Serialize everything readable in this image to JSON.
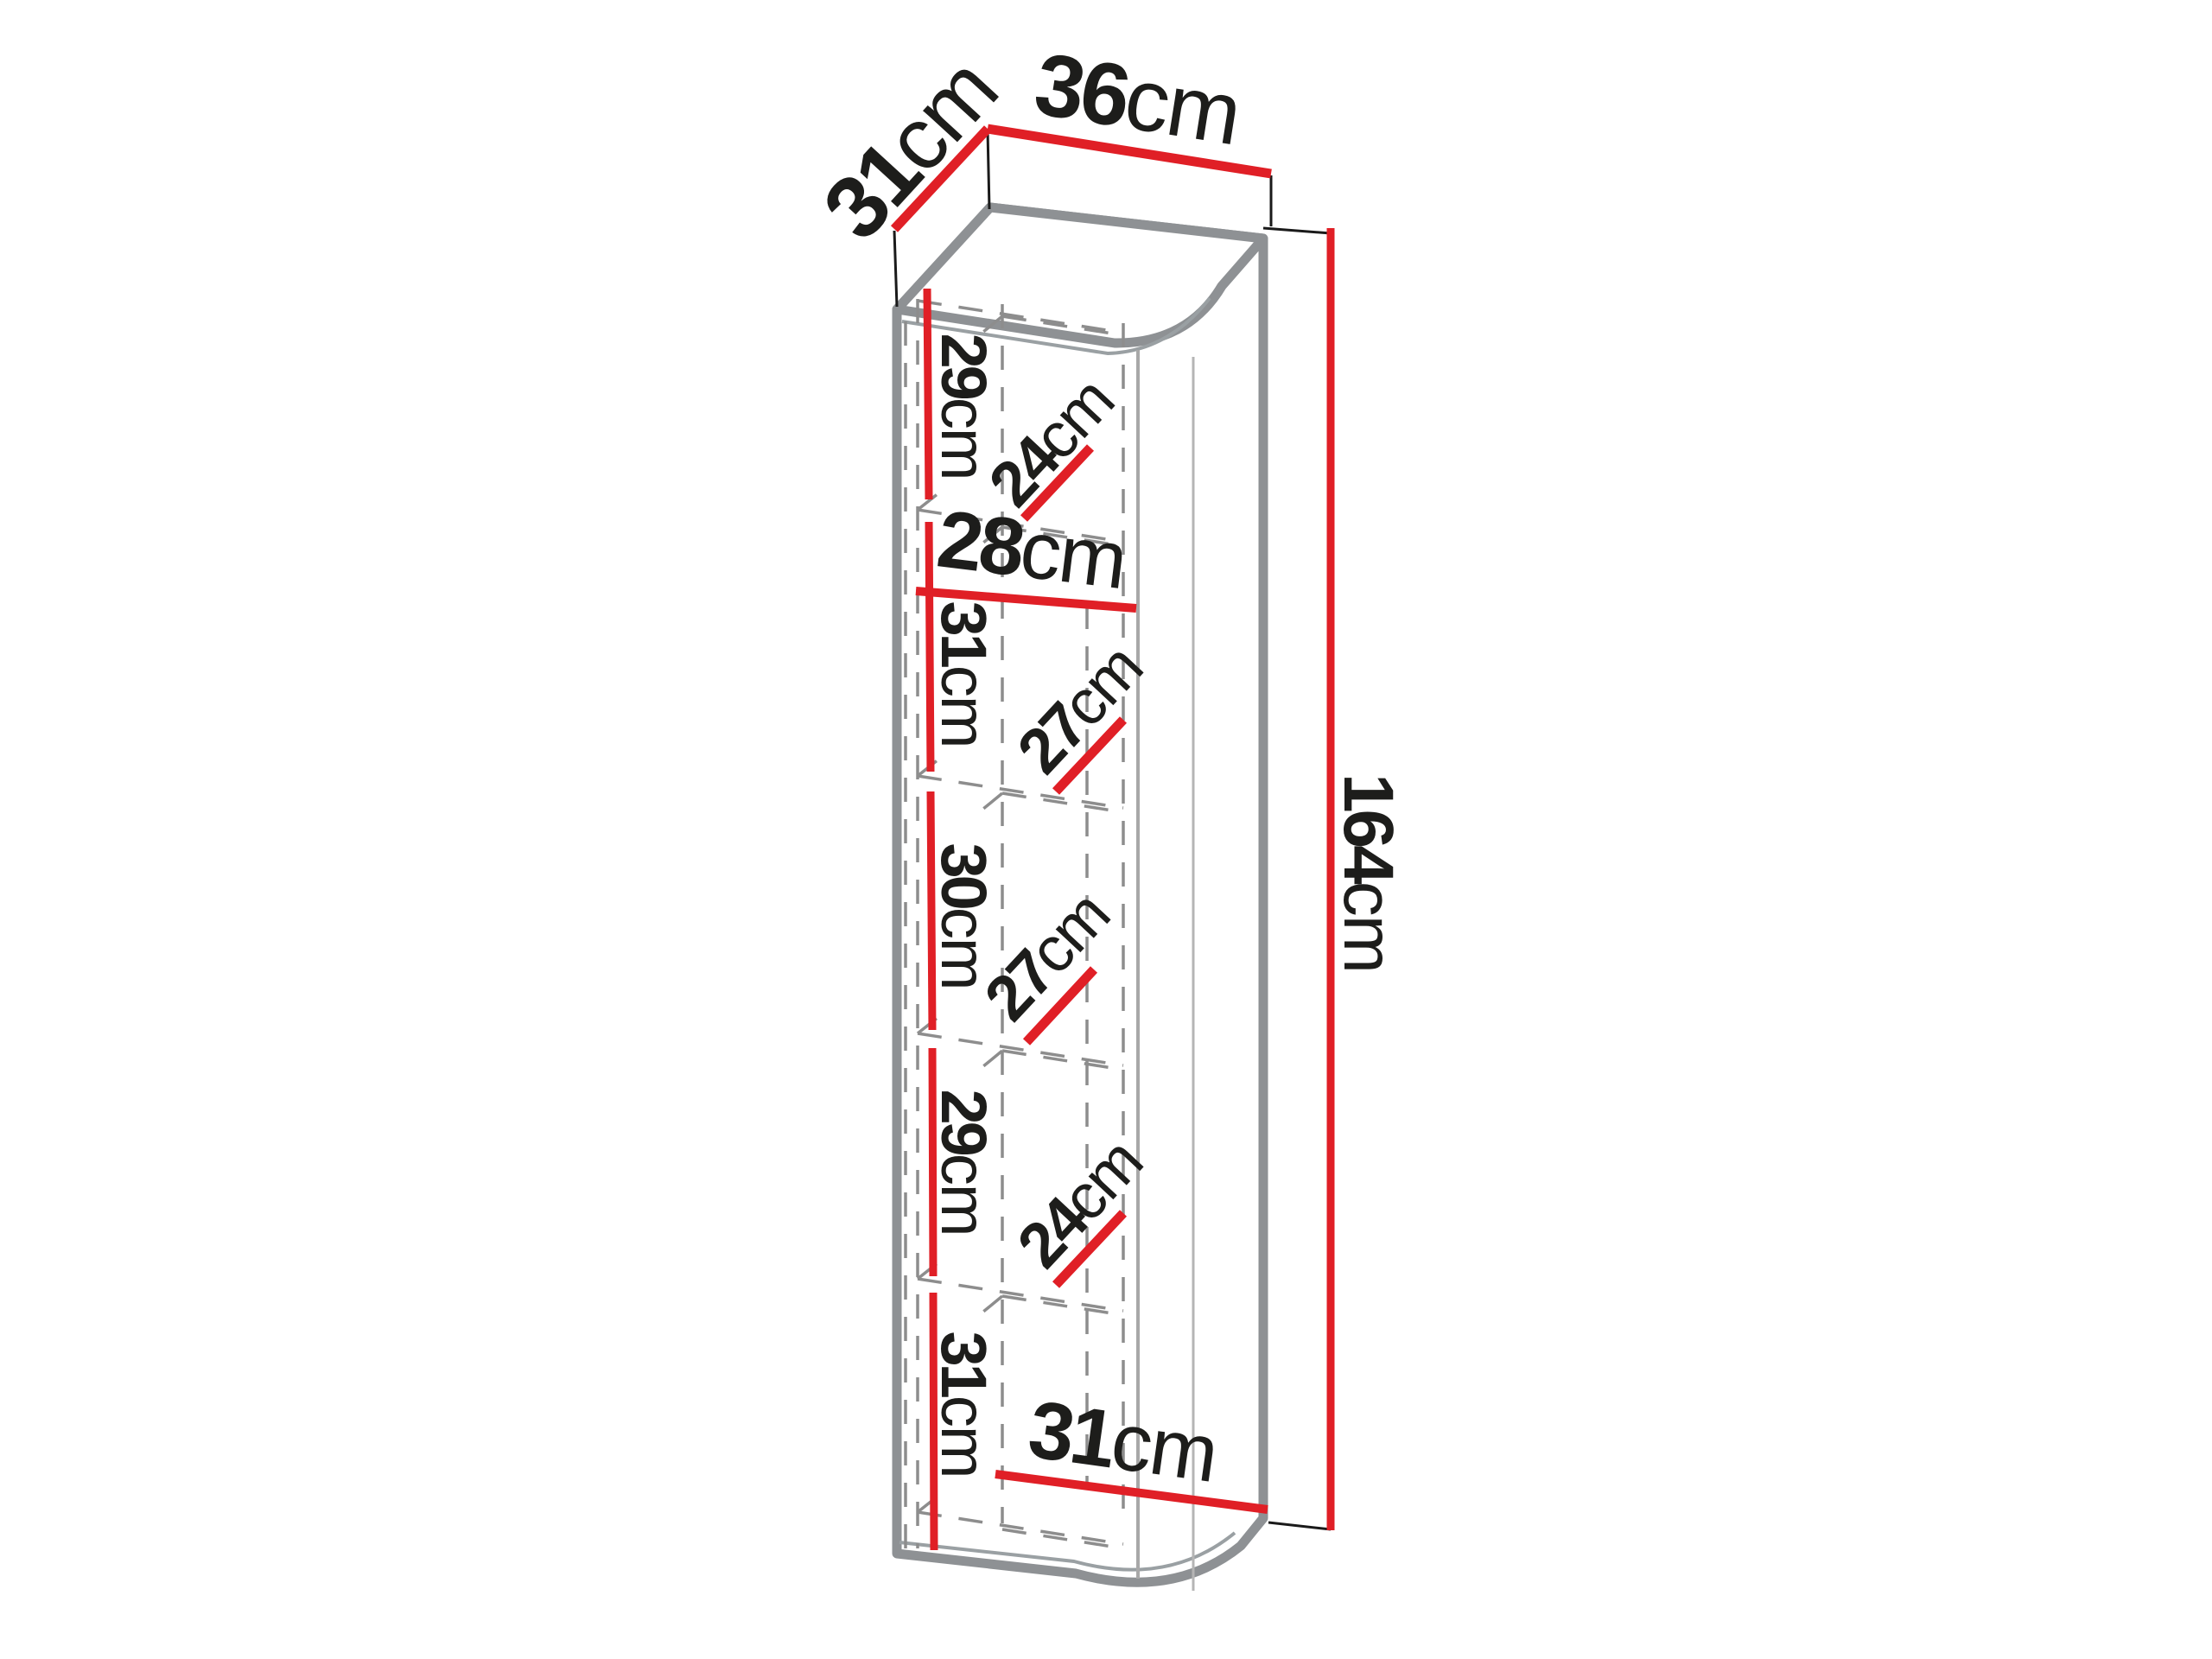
{
  "figure": {
    "kind": "furniture-dimension-diagram",
    "subject": "tall wall cabinet with five shelf compartments, perspective view",
    "units": "cm"
  },
  "colors": {
    "dimension_red": "#e01f26",
    "outline_gray": "#8e9194",
    "dash_gray": "#8d8d8d",
    "text_black": "#1d1d1b",
    "background": "#ffffff"
  },
  "labels": {
    "top_depth": {
      "value": "31",
      "unit": "cm"
    },
    "top_width": {
      "value": "36",
      "unit": "cm"
    },
    "height": {
      "value": "164",
      "unit": "cm"
    },
    "inner_width": {
      "value": "28",
      "unit": "cm"
    },
    "bottom_width": {
      "value": "31",
      "unit": "cm"
    },
    "shelf_heights": [
      {
        "value": "29",
        "unit": "cm"
      },
      {
        "value": "31",
        "unit": "cm"
      },
      {
        "value": "30",
        "unit": "cm"
      },
      {
        "value": "29",
        "unit": "cm"
      },
      {
        "value": "31",
        "unit": "cm"
      }
    ],
    "shelf_depths": [
      {
        "value": "24",
        "unit": "cm"
      },
      {
        "value": "27",
        "unit": "cm"
      },
      {
        "value": "27",
        "unit": "cm"
      },
      {
        "value": "24",
        "unit": "cm"
      }
    ]
  }
}
